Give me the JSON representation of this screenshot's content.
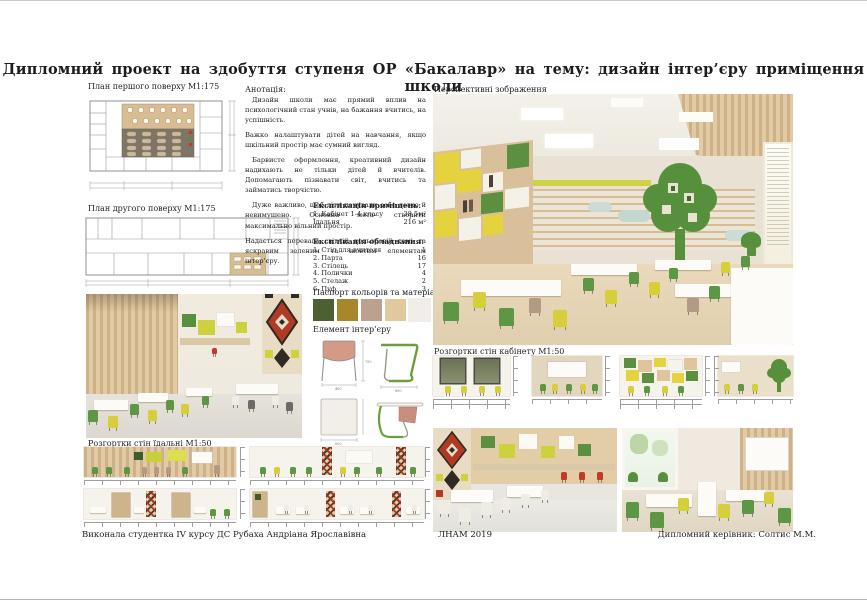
{
  "page": {
    "title": "Дипломний  проект   на здобуття ступеня ОР «Бакалавр»  на тему: дизайн  інтер’єру приміщення  школи"
  },
  "sections": {
    "plan1_label": "План першого поверху  М1:175",
    "plan2_label": "План другого поверху  М1:175",
    "annotation_title": "Анотація:",
    "perspective_label": "Перспективні зображення",
    "rooms_title": "Експлікація приміщень:",
    "equipment_title": "Експлікація обладнання:",
    "palette_title": "Паспорт кольорів та матеріалів",
    "element_title": "Елемент інтер’єру",
    "cabinet_elev_label": "Розгортки стін кабінету  М1:50",
    "dining_elev_label": "Розгортки стін їдальні  М1:50"
  },
  "annotation": {
    "paragraphs": [
      "Дизайн школи має прямий вплив на психологічний стан учнів, на бажання вчитись, на успішність.",
      "Важко налаштувати дітей на навчання, якщо шкільний простір має сумний вигляд.",
      "Барвисте оформлення, креативний дизайн надихають не тільки дітей й вчителів. Допомагають пізнавати світ, вчитись та займатись творчістю.",
      "Дуже важливо, щоб діти почували себе легко й невимушено. Основна мета- створити максимально вільний простір.",
      "Надається перевага світлій кольоровій гамі та яскравим зеленим та жовтим елементам інтер’єру."
    ]
  },
  "rooms_table": {
    "rows": [
      {
        "name": "1. Кабінет 1-4 класу",
        "value": "38,5м²"
      },
      {
        "name": "Їдальня",
        "value": "216 м²"
      }
    ]
  },
  "equipment_table": {
    "rows": [
      {
        "name": "1. Стіл для вчителя",
        "value": "1"
      },
      {
        "name": "2. Парта",
        "value": "16"
      },
      {
        "name": "3. Стілець",
        "value": "17"
      },
      {
        "name": "4. Полички",
        "value": "4"
      },
      {
        "name": "5. Стелаж",
        "value": "2"
      },
      {
        "name": "6. Пуф",
        "value": "3"
      }
    ]
  },
  "palette": {
    "colors": [
      "#4d6130",
      "#a8862c",
      "#bda08e",
      "#e2c89e",
      "#f1eeea"
    ]
  },
  "furniture_dims": {
    "chair_width": "400",
    "chair_height": "750",
    "desk_side": "800",
    "desk_width": "600"
  },
  "design_colors": {
    "accent_green": "#5d9743",
    "accent_yellow": "#d6ce3a",
    "wood": "#d9bd92",
    "ornament_red": "#a8402c",
    "ornament_dark": "#2f2a24"
  },
  "footer": {
    "student": "Виконала студентка  IV  курсу  ДС  Рубаха Андріана Ярославівна",
    "academy": "ЛНАМ 2019",
    "supervisor": "Дипломний керівник: Солтис М.М."
  }
}
